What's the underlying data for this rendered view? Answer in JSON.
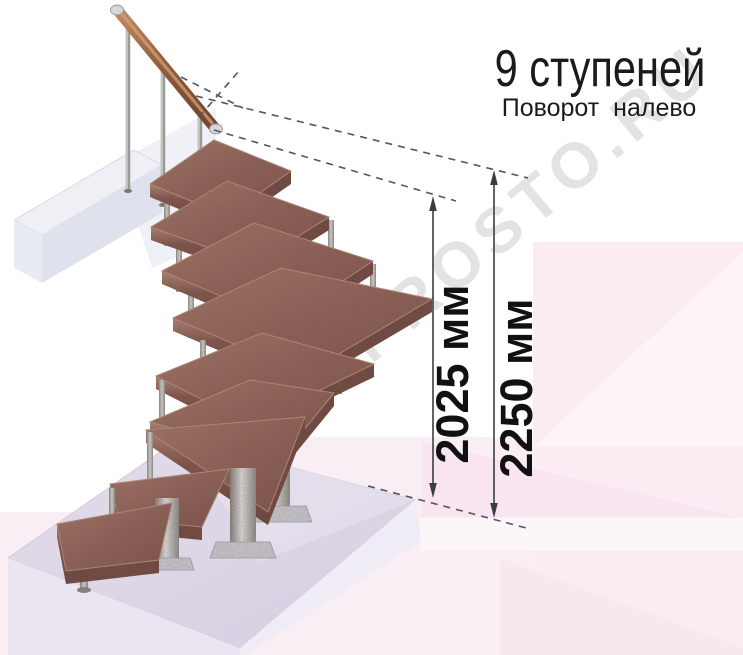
{
  "header": {
    "title": "9 ступеней",
    "subtitle": "Поворот налево"
  },
  "stair": {
    "steps_count": 9,
    "turn_direction": "налево"
  },
  "dimensions": [
    {
      "label": "2025 мм"
    },
    {
      "label": "2250 мм"
    }
  ],
  "watermark": {
    "text": "LESTNICA-PROSTO.RU"
  },
  "colors": {
    "tread_wood": "#8f635a",
    "metal_gray": "#b9bab8",
    "floor_slab": "#dcd5e5",
    "background_accent_pink": "#fbecf3",
    "text": "#1b1b1b"
  }
}
